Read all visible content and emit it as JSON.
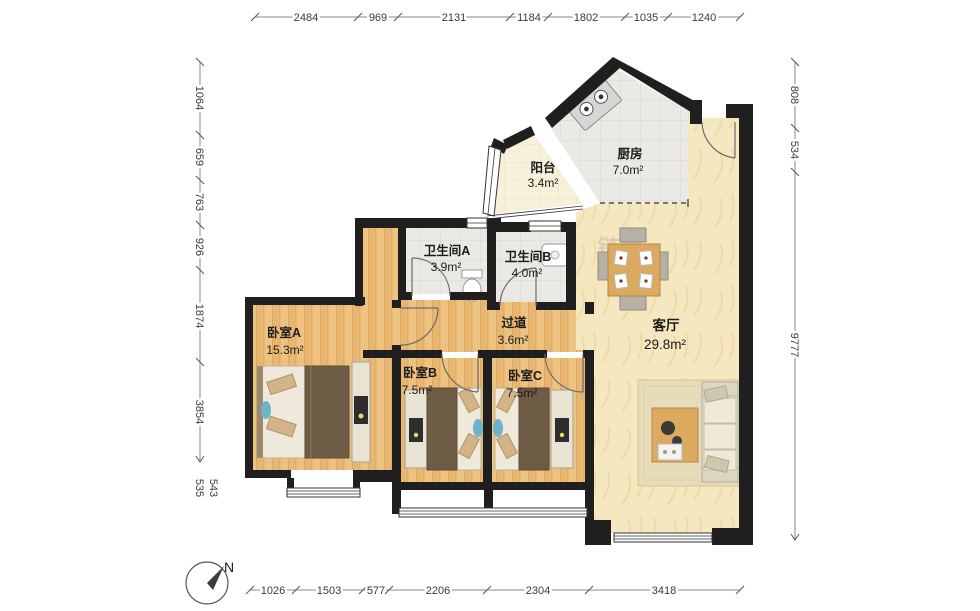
{
  "title": "户型图",
  "rooms": {
    "balcony": {
      "name": "阳台",
      "area": "3.4m²"
    },
    "kitchen": {
      "name": "厨房",
      "area": "7.0m²"
    },
    "bathA": {
      "name": "卫生间A",
      "area": "3.9m²"
    },
    "bathB": {
      "name": "卫生间B",
      "area": "4.0m²"
    },
    "hall": {
      "name": "过道",
      "area": "3.6m²"
    },
    "living": {
      "name": "客厅",
      "area": "29.8m²"
    },
    "bedA": {
      "name": "卧室A",
      "area": "15.3m²"
    },
    "bedB": {
      "name": "卧室B",
      "area": "7.5m²"
    },
    "bedC": {
      "name": "卧室C",
      "area": "7.5m²"
    }
  },
  "dimensions": {
    "top": [
      "2484",
      "969",
      "2131",
      "1184",
      "1802",
      "1035",
      "1240"
    ],
    "bottom": [
      "1026",
      "1503",
      "577",
      "2206",
      "2304",
      "3418"
    ],
    "left": [
      "1064",
      "659",
      "763",
      "926",
      "1874",
      "3854",
      "535",
      "543"
    ],
    "right": [
      "808",
      "534",
      "9777"
    ]
  },
  "compass": {
    "north_label": "N"
  },
  "watermark": "链家",
  "colors": {
    "wall": "#1f1f1f",
    "wood_floor": "#eec382",
    "living_floor": "#f5e8c0",
    "tile_floor": "#ebe9e3",
    "balcony_floor": "#f7f1da",
    "blanket": "#6e5c47",
    "table_wood": "#dcaa5e"
  }
}
